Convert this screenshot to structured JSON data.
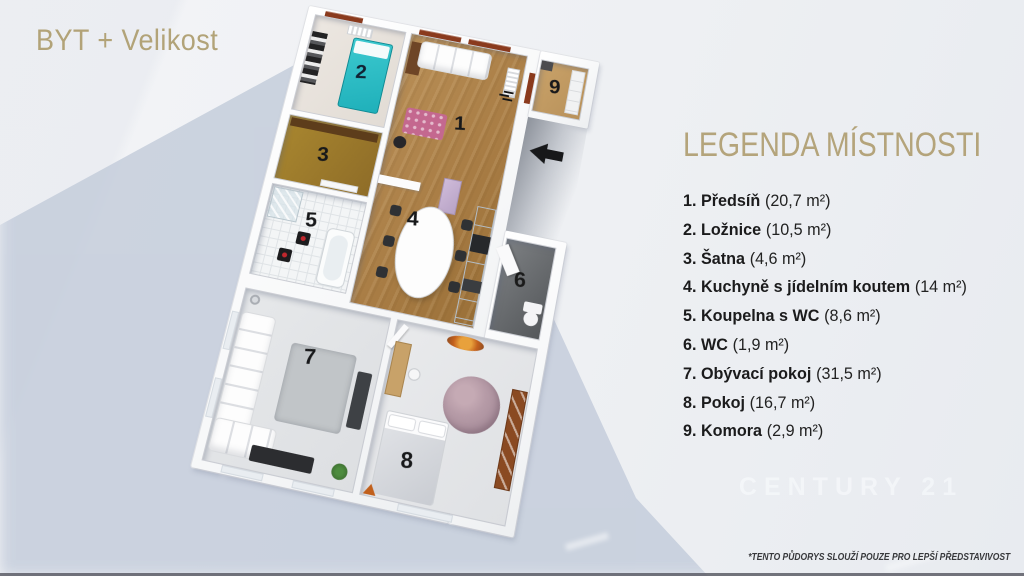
{
  "header": {
    "title": "BYT + Velikost"
  },
  "legend": {
    "heading": "LEGENDA MÍSTNOSTI",
    "items": [
      {
        "label": "1. Předsíň",
        "size": "(20,7 m²)"
      },
      {
        "label": "2. Ložnice",
        "size": "(10,5 m²)"
      },
      {
        "label": "3. Šatna",
        "size": "(4,6 m²)"
      },
      {
        "label": "4. Kuchyně s jídelním koutem",
        "size": "(14 m²)"
      },
      {
        "label": "5. Koupelna s WC",
        "size": "(8,6 m²)"
      },
      {
        "label": "6. WC",
        "size": "(1,9 m²)"
      },
      {
        "label": "7. Obývací pokoj",
        "size": "(31,5 m²)"
      },
      {
        "label": "8. Pokoj",
        "size": "(16,7 m²)"
      },
      {
        "label": "9. Komora",
        "size": "(2,9 m²)"
      }
    ]
  },
  "floorplan": {
    "rooms": [
      {
        "number": "1",
        "name": "Předsíň"
      },
      {
        "number": "2",
        "name": "Ložnice"
      },
      {
        "number": "3",
        "name": "Šatna"
      },
      {
        "number": "4",
        "name": "Kuchyně s jídelním koutem"
      },
      {
        "number": "5",
        "name": "Koupelna s WC"
      },
      {
        "number": "6",
        "name": "WC"
      },
      {
        "number": "7",
        "name": "Obývací pokoj"
      },
      {
        "number": "8",
        "name": "Pokoj"
      },
      {
        "number": "9",
        "name": "Komora"
      }
    ],
    "entrance_arrow": "left"
  },
  "footer": {
    "watermark": "CENTURY 21",
    "disclaimer": "*TENTO PŮDORYS SLOUŽÍ POUZE PRO LEPŠÍ PŘEDSTAVIVOST"
  },
  "colors": {
    "accent_gold": "#b3a37a",
    "wood_floor": "#ad824c",
    "teal_bed": "#2cc2c9",
    "window_frame": "#8a3a1d",
    "shadow_blue": "#c3cbda",
    "text_dark": "#1b1b1b"
  }
}
